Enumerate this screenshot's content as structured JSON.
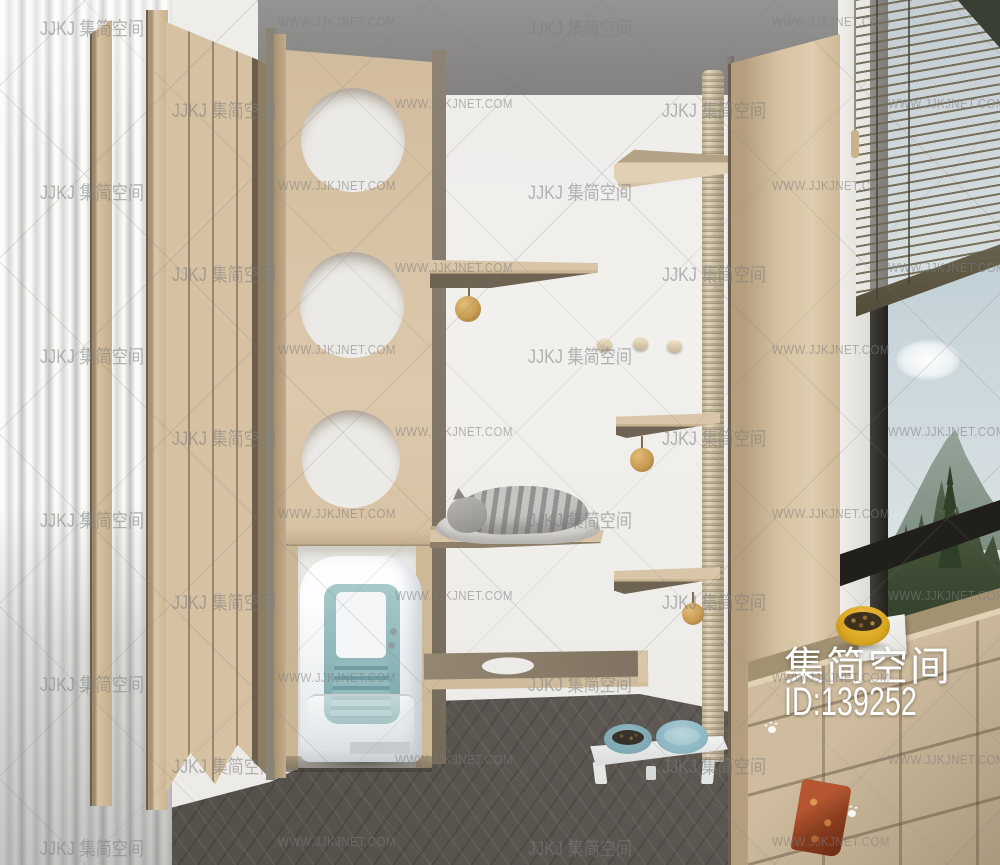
{
  "overlay": {
    "brand": "集简空间",
    "id_label": "ID:139252"
  },
  "watermarks": {
    "logo_text": "JJKJ 集简空间",
    "site_text": "WWW.JJKJNET.COM",
    "rows": [
      {
        "y": 14,
        "items": [
          {
            "x": 40,
            "t": "logo"
          },
          {
            "x": 278,
            "t": "site"
          },
          {
            "x": 528,
            "t": "logo"
          },
          {
            "x": 772,
            "t": "site"
          }
        ]
      },
      {
        "y": 96,
        "items": [
          {
            "x": 172,
            "t": "logo"
          },
          {
            "x": 395,
            "t": "site"
          },
          {
            "x": 662,
            "t": "logo"
          },
          {
            "x": 888,
            "t": "site"
          }
        ]
      },
      {
        "y": 178,
        "items": [
          {
            "x": 40,
            "t": "logo"
          },
          {
            "x": 278,
            "t": "site"
          },
          {
            "x": 528,
            "t": "logo"
          },
          {
            "x": 772,
            "t": "site"
          }
        ]
      },
      {
        "y": 260,
        "items": [
          {
            "x": 172,
            "t": "logo"
          },
          {
            "x": 395,
            "t": "site"
          },
          {
            "x": 662,
            "t": "logo"
          },
          {
            "x": 888,
            "t": "site"
          }
        ]
      },
      {
        "y": 342,
        "items": [
          {
            "x": 40,
            "t": "logo"
          },
          {
            "x": 278,
            "t": "site"
          },
          {
            "x": 528,
            "t": "logo"
          },
          {
            "x": 772,
            "t": "site"
          }
        ]
      },
      {
        "y": 424,
        "items": [
          {
            "x": 172,
            "t": "logo"
          },
          {
            "x": 395,
            "t": "site"
          },
          {
            "x": 662,
            "t": "logo"
          },
          {
            "x": 888,
            "t": "site"
          }
        ]
      },
      {
        "y": 506,
        "items": [
          {
            "x": 40,
            "t": "logo"
          },
          {
            "x": 278,
            "t": "site"
          },
          {
            "x": 528,
            "t": "logo"
          },
          {
            "x": 772,
            "t": "site"
          }
        ]
      },
      {
        "y": 588,
        "items": [
          {
            "x": 172,
            "t": "logo"
          },
          {
            "x": 395,
            "t": "site"
          },
          {
            "x": 662,
            "t": "logo"
          },
          {
            "x": 888,
            "t": "site"
          }
        ]
      },
      {
        "y": 670,
        "items": [
          {
            "x": 40,
            "t": "logo"
          },
          {
            "x": 278,
            "t": "site"
          },
          {
            "x": 528,
            "t": "logo"
          },
          {
            "x": 772,
            "t": "site"
          }
        ]
      },
      {
        "y": 752,
        "items": [
          {
            "x": 172,
            "t": "logo"
          },
          {
            "x": 395,
            "t": "site"
          },
          {
            "x": 662,
            "t": "logo"
          },
          {
            "x": 888,
            "t": "site"
          }
        ]
      },
      {
        "y": 834,
        "items": [
          {
            "x": 40,
            "t": "logo"
          },
          {
            "x": 278,
            "t": "site"
          },
          {
            "x": 528,
            "t": "logo"
          },
          {
            "x": 772,
            "t": "site"
          }
        ]
      }
    ]
  },
  "palette": {
    "wall": "#efeeec",
    "ceiling": "#8a8a88",
    "floor": "#55504a",
    "wood_light": "#d9c5a7",
    "wood_mid": "#c9b493",
    "wood_dark": "#8d7f69",
    "wood_seam": "#6e604c",
    "curtain_shadow": "#c3c3bf",
    "hole_fill": "#eceae7",
    "pole_light": "#e0d5bd",
    "pole_dark": "#b0a286",
    "teal": "#7aa6aa",
    "teal_light": "#a7c9ca",
    "litter_white": "#f3f5f6",
    "sky_top": "#9db3bf",
    "sky_bottom": "#dbe2e4",
    "mountain": "#7f8f82",
    "trees": "#3f4d35",
    "blind_slat": "#6e6752",
    "blind_rail": "#504a38",
    "frame_dark": "#211f1b",
    "ball_tan": "#c89c52",
    "bowl_yellow": "#d8a520",
    "bowl_blue": "#7fa9b4",
    "watermark_grey": "rgba(125,125,125,0.55)",
    "overlay_white": "#ffffff"
  }
}
